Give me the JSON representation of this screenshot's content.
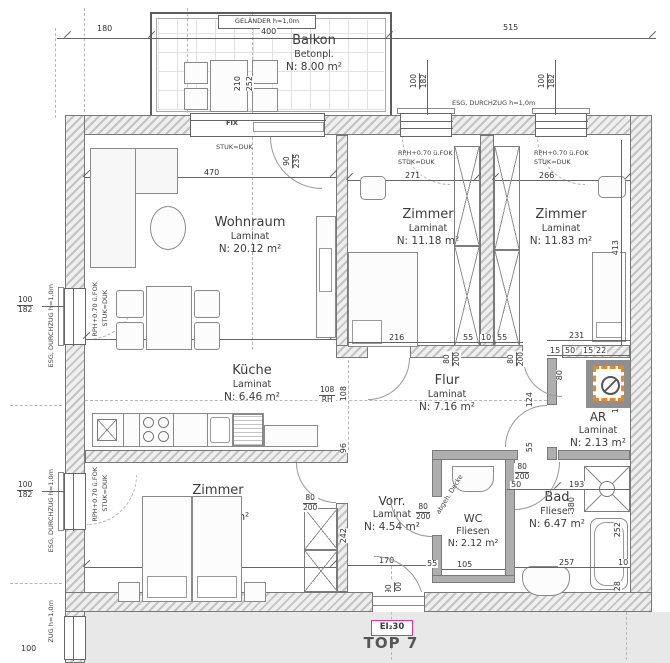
{
  "plan": {
    "top_label": "TOP 7",
    "fire_label": "EI₂30"
  },
  "rooms": {
    "balkon": {
      "name": "Balkon",
      "floor": "Betonpl.",
      "area": "N: 8.00 m²"
    },
    "wohnraum": {
      "name": "Wohnraum",
      "floor": "Laminat",
      "area": "N: 20.12 m²"
    },
    "zimmer_mid": {
      "name": "Zimmer",
      "floor": "Laminat",
      "area": "N: 11.18 m²"
    },
    "zimmer_right": {
      "name": "Zimmer",
      "floor": "Laminat",
      "area": "N: 11.83 m²"
    },
    "kueche": {
      "name": "Küche",
      "floor": "Laminat",
      "area": "N: 6.46 m²"
    },
    "flur": {
      "name": "Flur",
      "floor": "Laminat",
      "area": "N: 7.16 m²"
    },
    "ar": {
      "name": "AR",
      "floor": "Laminat",
      "area": "N: 2.13 m²"
    },
    "zimmer_bottom": {
      "name": "Zimmer",
      "floor": "Laminat",
      "area": "N: 13.84 m²"
    },
    "vorraum": {
      "name": "Vorr.",
      "floor": "Laminat",
      "area": "N: 4.54 m²"
    },
    "wc": {
      "name": "WC",
      "floor": "Fliesen",
      "area": "N: 2.12 m²"
    },
    "bad": {
      "name": "Bad",
      "floor": "Fliesen",
      "area": "N: 6.47 m²"
    }
  },
  "annotations": {
    "gelaender": "GELÄNDER  h=1,0m",
    "esg": "ESG, DURCHZUG h=1,0m",
    "esg_part": "ZUG h=1,0m",
    "fix": "FIX",
    "stuk": "STUK=DUK",
    "rph": "RPH+0.70 ü.FOK",
    "decke": "abgeh. Decke"
  },
  "openings": {
    "win": {
      "num": "100",
      "den": "182"
    },
    "balcony_door": {
      "num": "90",
      "den": "235"
    },
    "door80": {
      "num": "80",
      "den": "200"
    },
    "entry": {
      "num": "90",
      "den": "200"
    }
  },
  "dims": {
    "d180": "180",
    "d400": "400",
    "d515": "515",
    "d210": "210",
    "d252b": "252",
    "d470a": "470",
    "d470b": "470",
    "d271": "271",
    "d266": "266",
    "d413": "413",
    "d465": "465",
    "d216": "216",
    "d55a": "55",
    "d10a": "10",
    "d55b": "55",
    "d231": "231",
    "d15a": "15",
    "d50a": "50",
    "d15b": "15",
    "d22": "22",
    "d108v": "108",
    "d96": "96",
    "d242": "242",
    "d124": "124",
    "d55c": "55",
    "d55e": "55",
    "d80": "80",
    "d179": "179",
    "d170": "170",
    "d105": "105",
    "d50b": "50",
    "d193": "193",
    "d380": "380",
    "d252": "252",
    "d257": "257",
    "d10b": "10",
    "d28": "28",
    "d100": "100",
    "rh108": {
      "num": "108",
      "den": "RH"
    }
  },
  "colors": {
    "highlight": "#e8872a",
    "fire_box": "#d9359b",
    "outside": "#e8e8e8"
  }
}
